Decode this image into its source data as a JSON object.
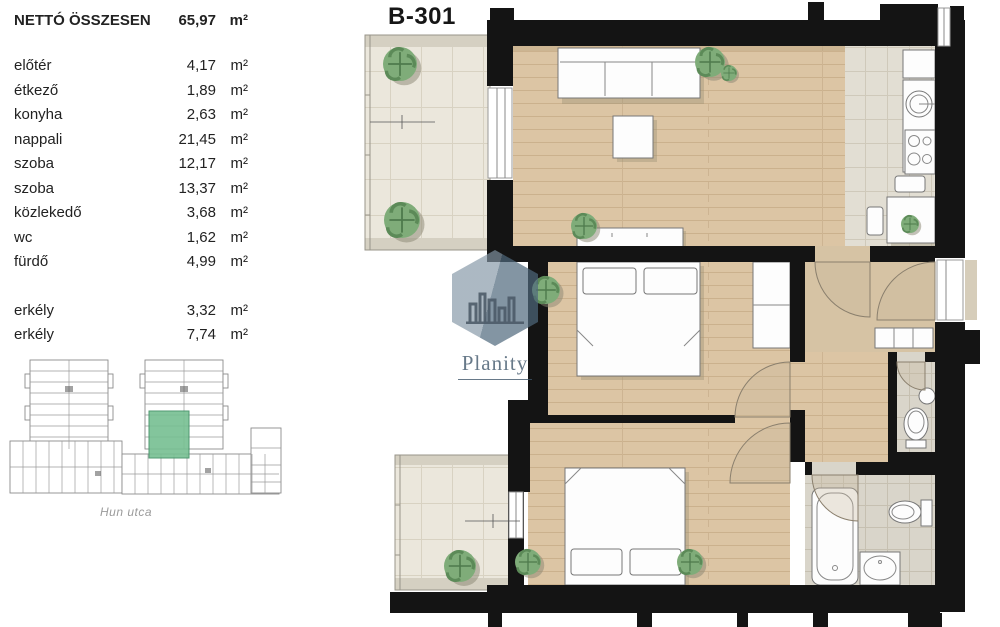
{
  "title": "B-301",
  "area_table": {
    "header": {
      "label": "NETTÓ ÖSSZESEN",
      "value": "65,97",
      "unit": "m²"
    },
    "rows": [
      {
        "label": "előtér",
        "value": "4,17",
        "unit": "m²"
      },
      {
        "label": "étkező",
        "value": "1,89",
        "unit": "m²"
      },
      {
        "label": "konyha",
        "value": "2,63",
        "unit": "m²"
      },
      {
        "label": "nappali",
        "value": "21,45",
        "unit": "m²"
      },
      {
        "label": "szoba",
        "value": "12,17",
        "unit": "m²"
      },
      {
        "label": "szoba",
        "value": "13,37",
        "unit": "m²"
      },
      {
        "label": "közlekedő",
        "value": "3,68",
        "unit": "m²"
      },
      {
        "label": "wc",
        "value": "1,62",
        "unit": "m²"
      },
      {
        "label": "fürdő",
        "value": "4,99",
        "unit": "m²"
      },
      {
        "label": "erkély",
        "value": "3,32",
        "unit": "m²"
      },
      {
        "label": "erkély",
        "value": "7,74",
        "unit": "m²"
      }
    ]
  },
  "site_plan": {
    "street_label": "Hun utca",
    "highlight_color": "#76bf92"
  },
  "watermark": {
    "brand": "Planity"
  },
  "floor_plan": {
    "colors": {
      "wall": "#141414",
      "wood_floor": "#dcc5a4",
      "balcony_tile": "#ebe7dc",
      "wet_tile": "#dfdbd0",
      "plant": "#7fac79",
      "highlight": "#76bf92"
    }
  }
}
